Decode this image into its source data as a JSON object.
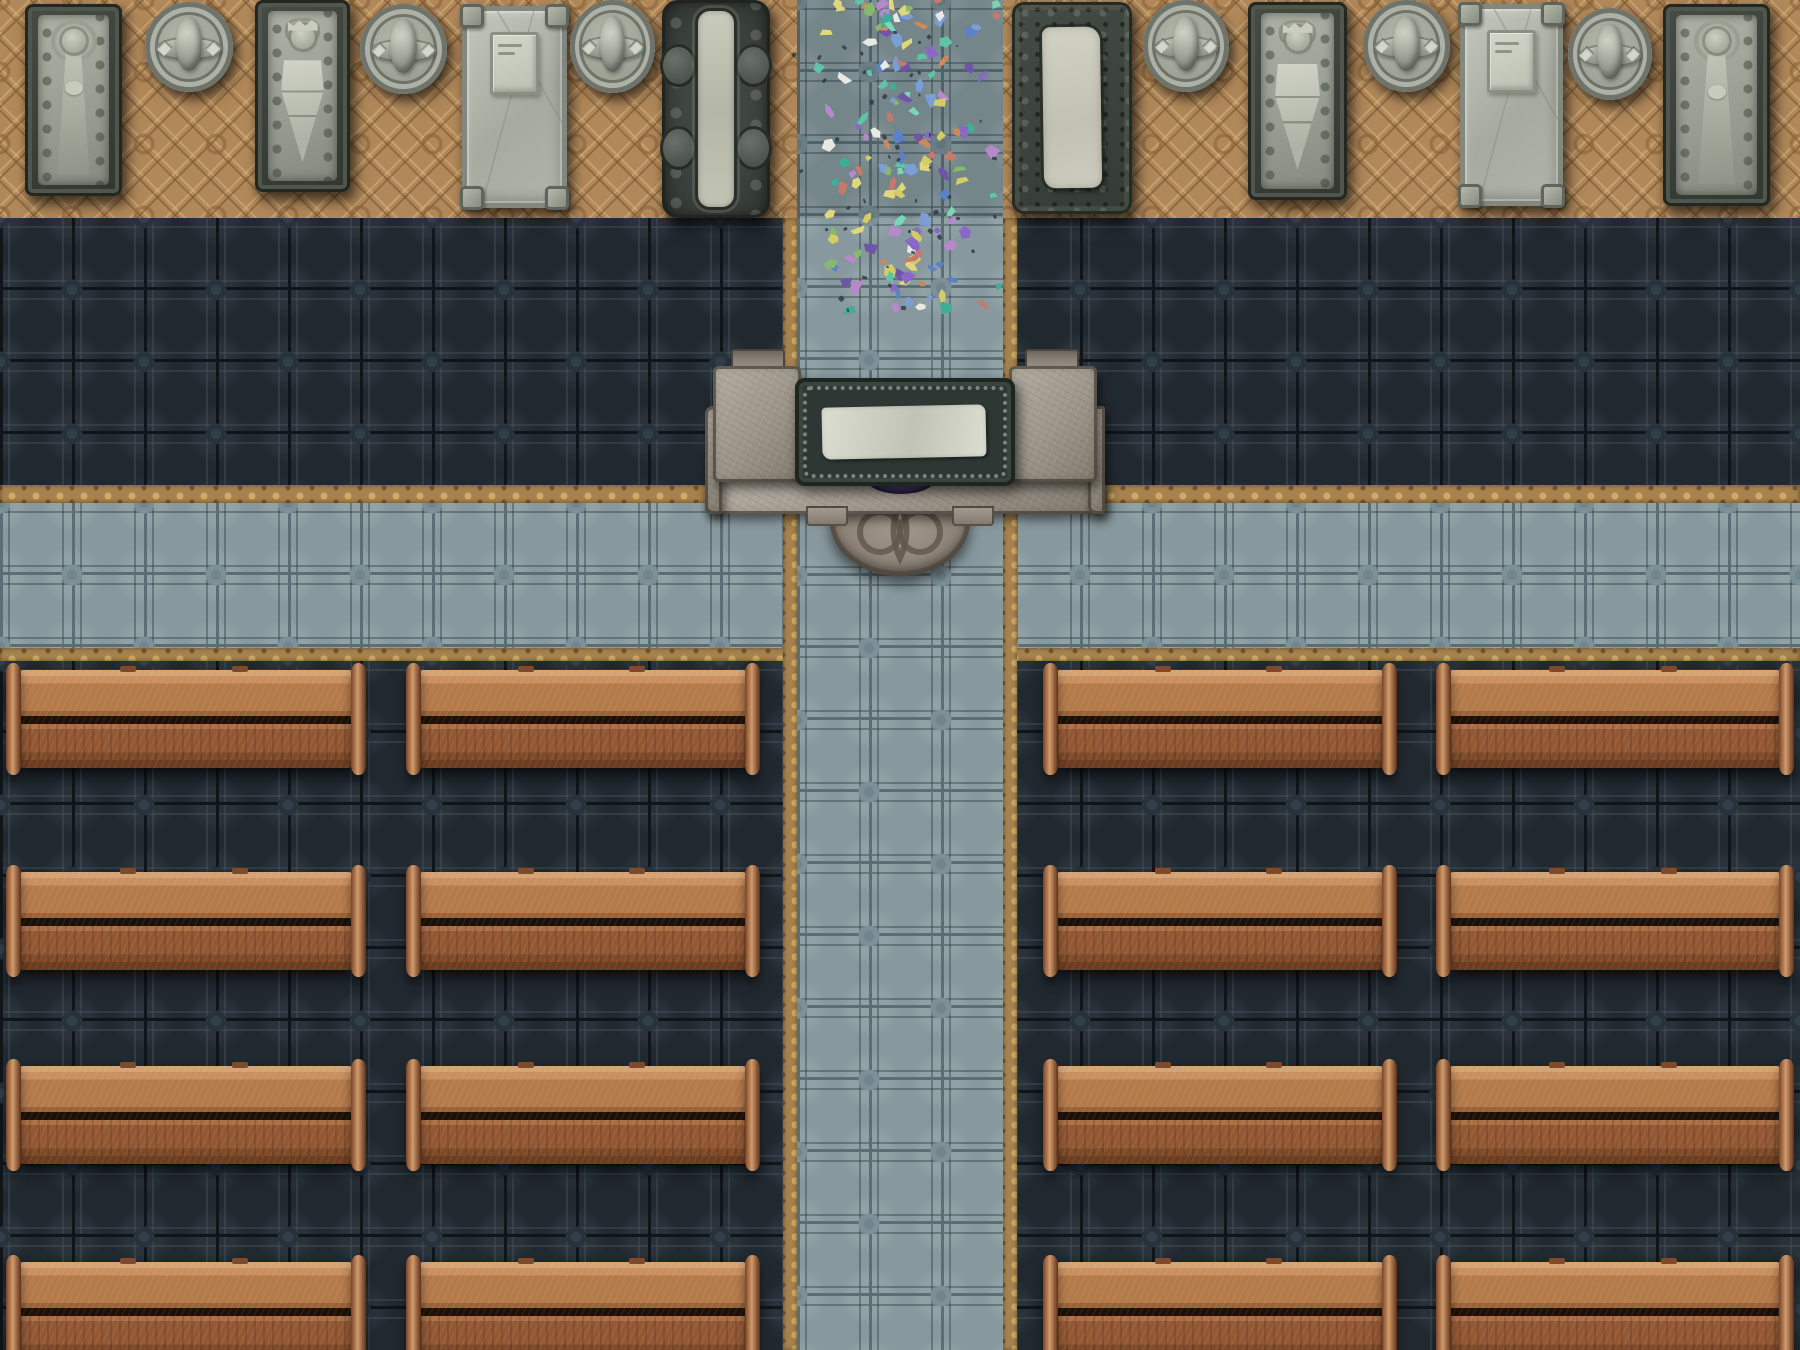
{
  "scene": {
    "kind": "top-down church battle map",
    "grid_px": 72,
    "description": "Cathedral nave: tomb gallery along top wall, dark tiled nave floor, cross-shaped pale aisle, central stone altar with cloth and apse step, scattered stained-glass shards in the upper aisle, four blocks of wooden pews"
  },
  "canvas": {
    "w": 1800,
    "h": 1350
  },
  "palette": {
    "tan_base": "#b1885a",
    "tan_line": "rgba(118,84,46,0.55)",
    "tan_light": "rgba(219,183,126,0.5)",
    "tan_ring": "rgba(139,100,56,0.6)",
    "strip_base": "#a5824e",
    "strip_light": "rgba(214,178,106,0.85)",
    "strip_dark": "rgba(101,76,40,0.8)",
    "dark_base": "#212930",
    "dark_grout": "#0f1519",
    "dark_motif": "#323f4a",
    "dark_motif2": "#28323b",
    "dark_frame": "rgba(70,86,99,0.4)",
    "dark_sheen": "rgba(148,170,182,0.07)",
    "aisle_base": "#87999e",
    "aisle_grout": "#5b6e75",
    "aisle_motif": "#70858c",
    "aisle_motif2": "#7d9097",
    "aisle_frame": "rgba(52,68,76,0.45)",
    "aisle_sheen": "rgba(238,245,243,0.10)",
    "stone_light": "#c6c9bb",
    "stone_body_hi": "#aeb2a6",
    "stone_body": "#979c91",
    "stone_body_lo": "#858a80",
    "stone_detail": "#6e746b",
    "slab_hi": "#c3c6bb",
    "slab_lo": "#a6aa9f",
    "slab_border": "#83887f",
    "altar_stone_hi": "#b3ada1",
    "altar_stone": "#9c958a",
    "altar_stone_lo": "#827b6f",
    "altar_edge": "rgba(58,50,42,0.6)",
    "table_dark": "#2e3733",
    "table_border": "#1e2622",
    "table_scroll": "rgba(186,199,191,0.55)",
    "cloth_hi": "#dcddd1",
    "cloth_lo": "#c2c3b7",
    "gem_hi": "#6d5796",
    "gem": "#463767",
    "gem_dark": "#251d40",
    "dais_hi": "#a89e92",
    "dais": "#8d8377",
    "dais_lo": "#6f675b",
    "dais_line": "#60564a",
    "pew_rail_top": "#d4a273",
    "pew_back_hi": "#c98f5f",
    "pew_back": "#b47a4a",
    "pew_back_lo": "#9a6239",
    "pew_gap": "#1c1006",
    "pew_seat_hi": "#aa6f44",
    "pew_seat": "#935833",
    "pew_rail": "#7e4a29",
    "pew_base": "#6b3c20",
    "pew_cap_dark": "#7a4426",
    "pew_cap_hi": "#d09a6b",
    "pew_cap_dark2": "#5e3119"
  },
  "regions": [
    {
      "name": "floor-top-tan",
      "pattern": "tan",
      "x": 0,
      "y": 0,
      "w": 1800,
      "h": 218
    },
    {
      "name": "floor-dark-band",
      "pattern": "dark",
      "x": 0,
      "y": 218,
      "w": 1800,
      "h": 285
    },
    {
      "name": "floor-dark-bottom",
      "pattern": "dark",
      "x": 0,
      "y": 661,
      "w": 1800,
      "h": 689
    },
    {
      "name": "border-h-upper-left",
      "pattern": "strip",
      "x": 0,
      "y": 485,
      "w": 797,
      "h": 18
    },
    {
      "name": "border-h-upper-right",
      "pattern": "strip",
      "x": 1003,
      "y": 485,
      "w": 797,
      "h": 18
    },
    {
      "name": "aisle-horizontal",
      "pattern": "aisle",
      "x": 0,
      "y": 503,
      "w": 1800,
      "h": 145
    },
    {
      "name": "border-h-lower-left",
      "pattern": "strip",
      "x": 0,
      "y": 648,
      "w": 797,
      "h": 13
    },
    {
      "name": "border-h-lower-right",
      "pattern": "strip",
      "x": 1003,
      "y": 648,
      "w": 797,
      "h": 13
    },
    {
      "name": "border-v-left",
      "pattern": "strip",
      "x": 783,
      "y": 218,
      "w": 14,
      "h": 1132
    },
    {
      "name": "border-v-right",
      "pattern": "strip",
      "x": 1003,
      "y": 218,
      "w": 14,
      "h": 1132
    },
    {
      "name": "aisle-vertical",
      "pattern": "aisle",
      "x": 797,
      "y": 0,
      "w": 206,
      "h": 1350
    },
    {
      "name": "aisle-vertical-shade",
      "pattern": "shade",
      "x": 797,
      "y": 0,
      "w": 206,
      "h": 218
    }
  ],
  "memorials": {
    "items": [
      {
        "type": "effigy-lady",
        "motif": "female effigy in gown",
        "x": 25,
        "y": 4,
        "w": 97,
        "h": 192
      },
      {
        "type": "medallion",
        "motif": "heraldic roundel",
        "x": 145,
        "y": 2,
        "w": 88,
        "h": 90
      },
      {
        "type": "effigy-knight",
        "motif": "knight effigy with shield",
        "x": 255,
        "y": 0,
        "w": 95,
        "h": 192
      },
      {
        "type": "medallion",
        "motif": "heraldic roundel",
        "x": 360,
        "y": 4,
        "w": 87,
        "h": 90
      },
      {
        "type": "slab",
        "motif": "plain slab with plaque",
        "x": 462,
        "y": 6,
        "w": 105,
        "h": 202
      },
      {
        "type": "medallion",
        "motif": "heraldic roundel",
        "x": 570,
        "y": 0,
        "w": 85,
        "h": 93
      },
      {
        "type": "ornate-strip",
        "motif": "ornate relief, central band",
        "x": 662,
        "y": 0,
        "w": 108,
        "h": 218
      },
      {
        "type": "ornate-frame",
        "motif": "scrolled frame, pale slab",
        "x": 1012,
        "y": 2,
        "w": 120,
        "h": 212
      },
      {
        "type": "medallion",
        "motif": "heraldic roundel",
        "x": 1143,
        "y": 0,
        "w": 86,
        "h": 92
      },
      {
        "type": "effigy-knight",
        "motif": "crowned knight with shield",
        "x": 1248,
        "y": 2,
        "w": 99,
        "h": 198
      },
      {
        "type": "medallion",
        "motif": "heraldic roundel",
        "x": 1363,
        "y": 0,
        "w": 87,
        "h": 92
      },
      {
        "type": "slab",
        "motif": "plain slab with plaque",
        "x": 1460,
        "y": 4,
        "w": 103,
        "h": 202
      },
      {
        "type": "medallion",
        "motif": "heraldic roundel",
        "x": 1568,
        "y": 8,
        "w": 84,
        "h": 92
      },
      {
        "type": "effigy-lady",
        "motif": "female effigy in gown",
        "x": 1663,
        "y": 4,
        "w": 107,
        "h": 202
      }
    ]
  },
  "altar": {
    "parts": [
      {
        "name": "altar-dais",
        "cls": "altar-dais",
        "x": 830,
        "y": 498,
        "w": 140,
        "h": 78,
        "knot": true
      },
      {
        "name": "altar-platform-bar",
        "cls": "altar-stone",
        "x": 705,
        "y": 478,
        "w": 400,
        "h": 36
      },
      {
        "name": "altar-wing-left",
        "cls": "altar-stone wing",
        "x": 705,
        "y": 406,
        "w": 17,
        "h": 108
      },
      {
        "name": "altar-wing-right",
        "cls": "altar-stone wing",
        "x": 1088,
        "y": 406,
        "w": 17,
        "h": 108
      },
      {
        "name": "altar-tab-left",
        "cls": "altar-tab",
        "x": 806,
        "y": 506,
        "w": 42,
        "h": 20
      },
      {
        "name": "altar-tab-right",
        "cls": "altar-tab",
        "x": 952,
        "y": 506,
        "w": 42,
        "h": 20
      },
      {
        "name": "altar-gem",
        "cls": "altar-gem",
        "x": 866,
        "y": 476,
        "w": 70,
        "h": 18
      },
      {
        "name": "altar-nub-left",
        "cls": "altar-nub",
        "x": 731,
        "y": 349,
        "w": 54,
        "h": 20
      },
      {
        "name": "altar-nub-right",
        "cls": "altar-nub",
        "x": 1025,
        "y": 349,
        "w": 54,
        "h": 20
      },
      {
        "name": "altar-block-left",
        "cls": "altar-stone",
        "x": 713,
        "y": 366,
        "w": 88,
        "h": 116
      },
      {
        "name": "altar-block-right",
        "cls": "altar-stone",
        "x": 1009,
        "y": 366,
        "w": 88,
        "h": 116
      },
      {
        "name": "altar-table",
        "cls": "altar-table",
        "x": 795,
        "y": 378,
        "w": 220,
        "h": 108,
        "scroll": true
      },
      {
        "name": "altar-cloth",
        "cls": "altar-cloth",
        "x": 822,
        "y": 406,
        "w": 164,
        "h": 52
      }
    ]
  },
  "pews": {
    "row_tops": [
      670,
      872,
      1066,
      1262
    ],
    "body_height": 98,
    "columns": [
      {
        "x": 20,
        "w": 332
      },
      {
        "x": 420,
        "w": 326
      },
      {
        "x": 1057,
        "w": 326
      },
      {
        "x": 1450,
        "w": 330
      }
    ]
  },
  "confetti": {
    "seed": 12,
    "count": 150,
    "speck_count": 45,
    "x_center": 900,
    "x_spread": 100,
    "y_min": -6,
    "y_max": 308,
    "colors": [
      "#8a68c8",
      "#6f55a8",
      "#5fc4a5",
      "#7ad6b8",
      "#7b9fd4",
      "#5b82c8",
      "#d4cc66",
      "#e0d77a",
      "#cc8a5a",
      "#c87a6a",
      "#e9e9e4",
      "#3fae98",
      "#b789cc",
      "#88b870"
    ],
    "speck_color": "#2b3642"
  }
}
